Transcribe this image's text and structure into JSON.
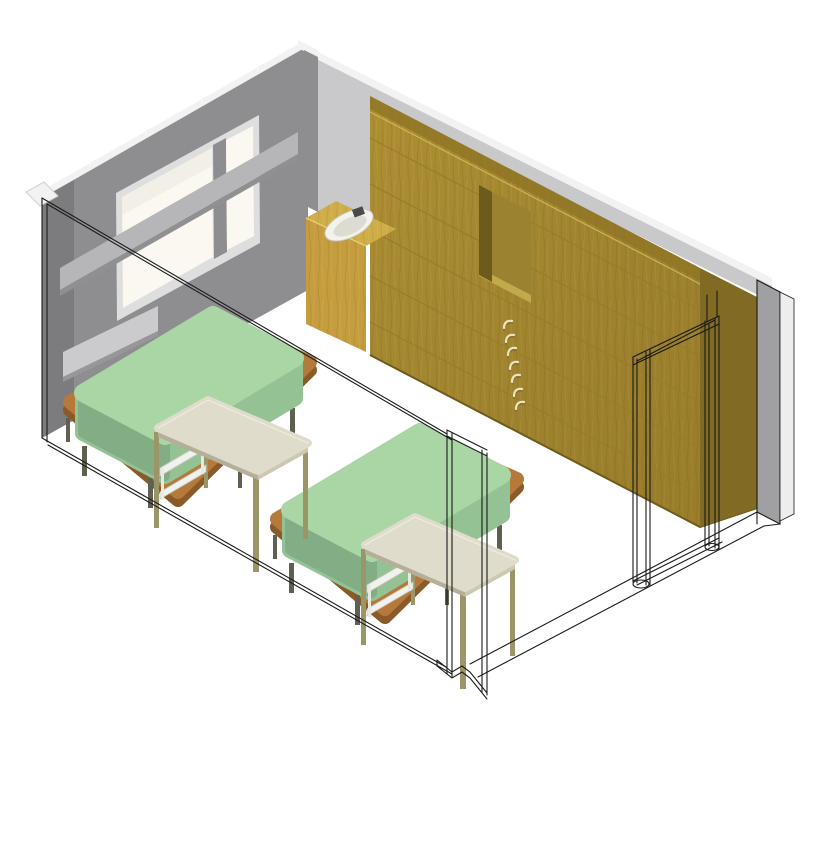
{
  "view": {
    "label": "Axonometric 3D cutaway view of a two-bed room: gray window wall, wood feature wall with recessed niche and coat hooks, corner sink counter, two green beds with side tables, and wireframe door frame on the cut front wall",
    "projection": "axonometric"
  },
  "scene": {
    "left_wall": {
      "label": "gray wall with window",
      "window_panes": 2
    },
    "back_wall": {
      "label": "wood panel feature wall",
      "plank_seams": 5
    },
    "right_wall": {
      "label": "gray wall end strip"
    },
    "front_walls": {
      "label": "cut walls shown as black wireframe outlines"
    },
    "niche": {
      "label": "recessed niche in wood wall"
    },
    "hooks": {
      "label": "coat hooks on wood wall",
      "count": 7
    },
    "sink": {
      "label": "corner sink counter",
      "basin": "white oval basin",
      "faucet": "dark gray"
    },
    "beds": {
      "label": "beds with green mattresses on wood platforms",
      "count": 2
    },
    "tables": {
      "label": "side tables with cream tops and olive legs",
      "count": 2
    },
    "door": {
      "label": "wireframe door frame opening",
      "leaves_visible": 0
    }
  },
  "colors": {
    "line_black": "#1a1a1a",
    "wall_gray": "#8e8e90",
    "wall_gray_dark": "#7c7c7e",
    "wall_light": "#c9c9cb",
    "cap_white": "#f2f2f2",
    "glass": "#faf8f0",
    "frame_light": "#dededf",
    "sill_light": "#b6b6b8",
    "panel_light": "#cbcbcd",
    "wood": "#ae8f33",
    "wood_light": "#cfae4a",
    "wood_dark": "#816a24",
    "wood_seam": "#977c28",
    "niche_back": "#9b8231",
    "niche_side": "#6f5a1e",
    "niche_shelf": "#c3a94e",
    "hook_cream": "#ece3c0",
    "mattress_top": "#a9d6a4",
    "mattress_side": "#94c294",
    "mattress_side_dark": "#83ad85",
    "platform_wood": "#b5793c",
    "platform_dark": "#8a5a28",
    "leg_dark": "#606051",
    "table_top": "#dfdccb",
    "table_edge": "#b5af99",
    "table_edge_light": "#cdc8b2",
    "table_leg": "#9b9668",
    "shelf_white": "#f1f1ed",
    "basin_white": "#f3f3ec",
    "basin_shadow": "#dcdcd2",
    "faucet_dark": "#4a4a46",
    "right_strip": "#a0a0a2",
    "edge_white": "#ededee"
  }
}
